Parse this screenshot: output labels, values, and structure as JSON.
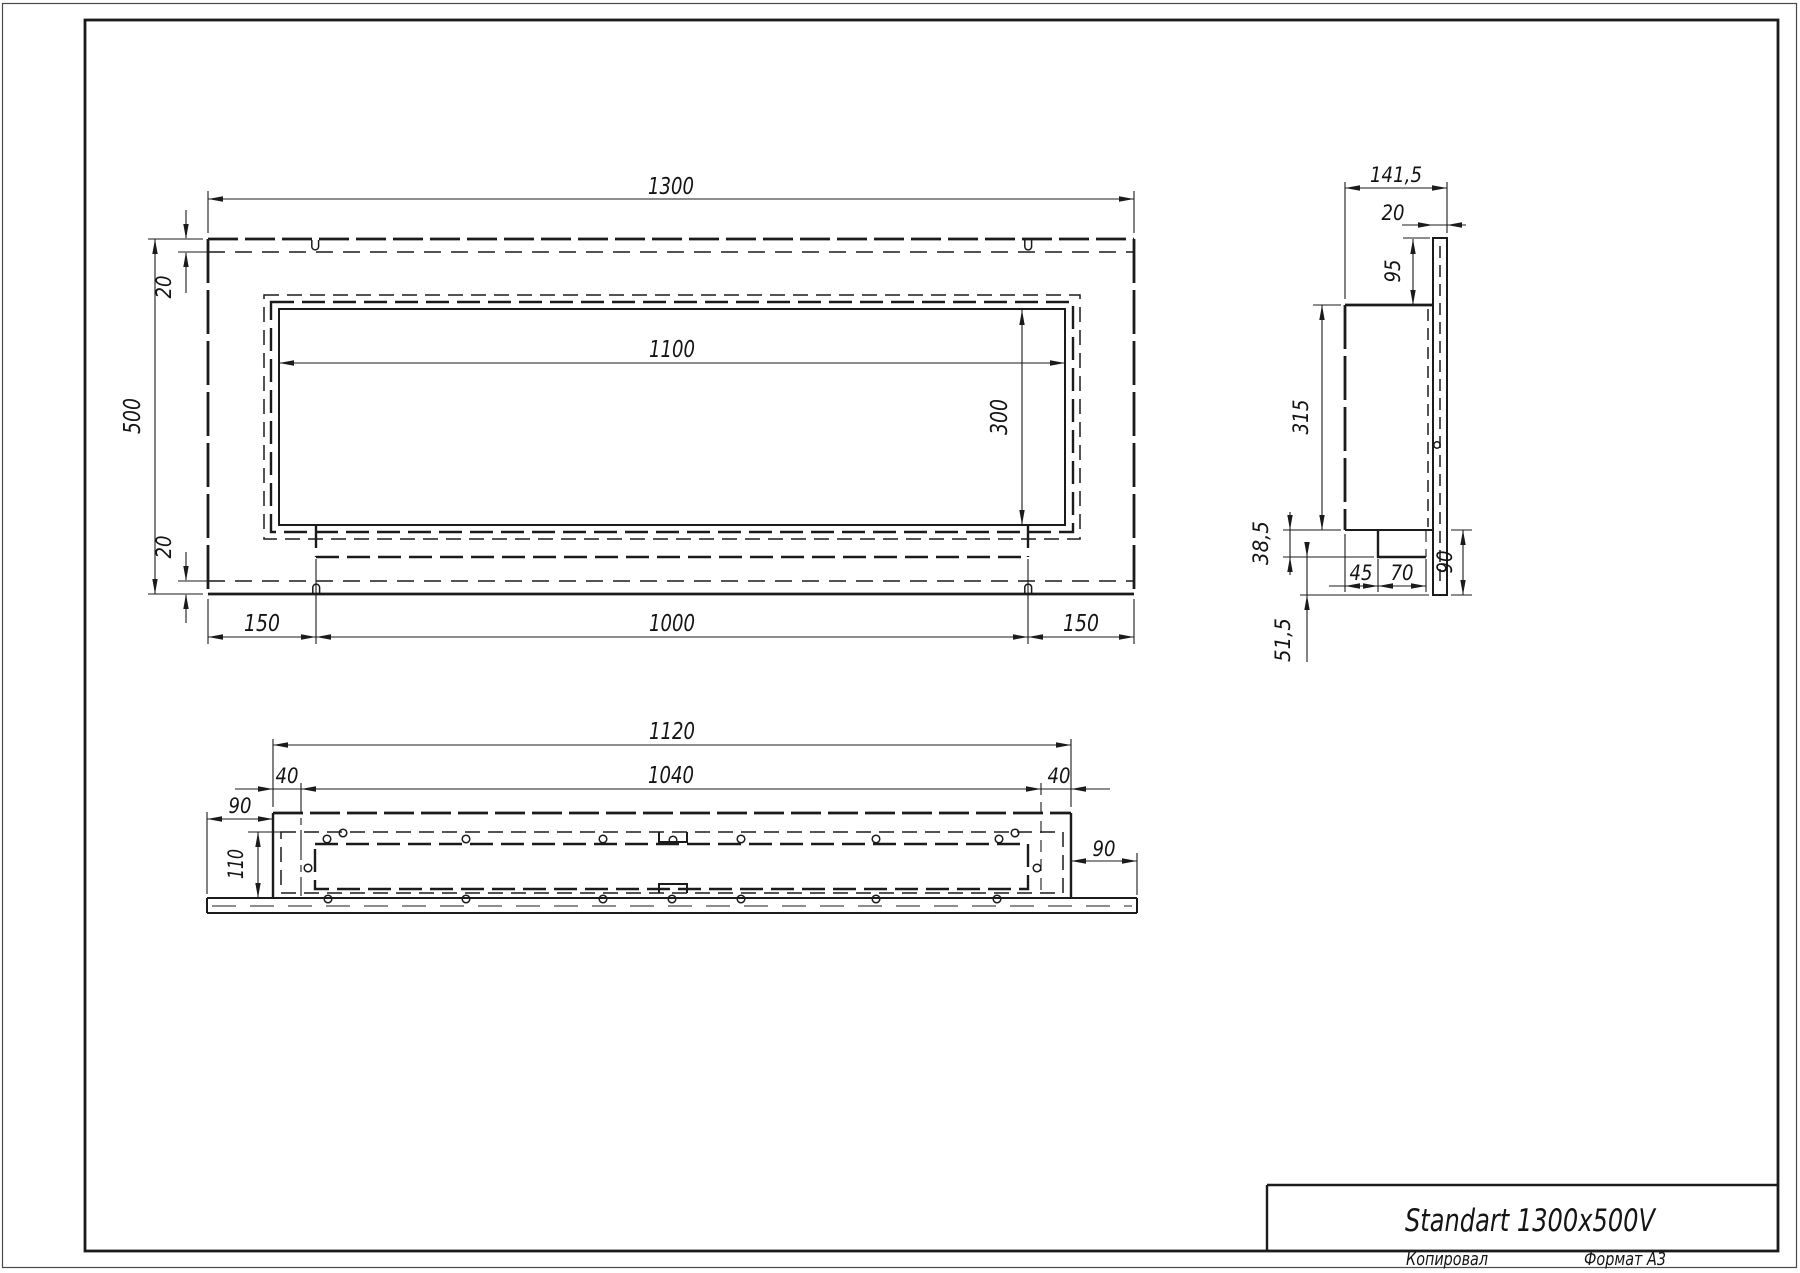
{
  "title_block": {
    "title": "Standart 1300x500V",
    "copied_label": "Копировал",
    "format_label": "Формат А3"
  },
  "colors": {
    "ink": "#1b1b1b",
    "paper": "#ffffff"
  },
  "front_view": {
    "dims": {
      "width": "1300",
      "height": "500",
      "opening_width": "1100",
      "opening_height": "300",
      "top_inset": "20",
      "bottom_inset": "20",
      "left_offset": "150",
      "center_width": "1000",
      "right_offset": "150"
    }
  },
  "side_view": {
    "dims": {
      "depth": "141,5",
      "back_plate": "20",
      "top_drop": "95",
      "body_height": "315",
      "ledge_drop": "38,5",
      "ledge_inset": "45",
      "ledge_width": "70",
      "flange_height": "90",
      "bottom_drop": "51,5"
    }
  },
  "bottom_view": {
    "dims": {
      "outer_width": "1120",
      "inner_width": "1040",
      "left_inset": "40",
      "right_inset": "40",
      "left_flange": "90",
      "right_flange": "90",
      "depth": "110"
    }
  }
}
